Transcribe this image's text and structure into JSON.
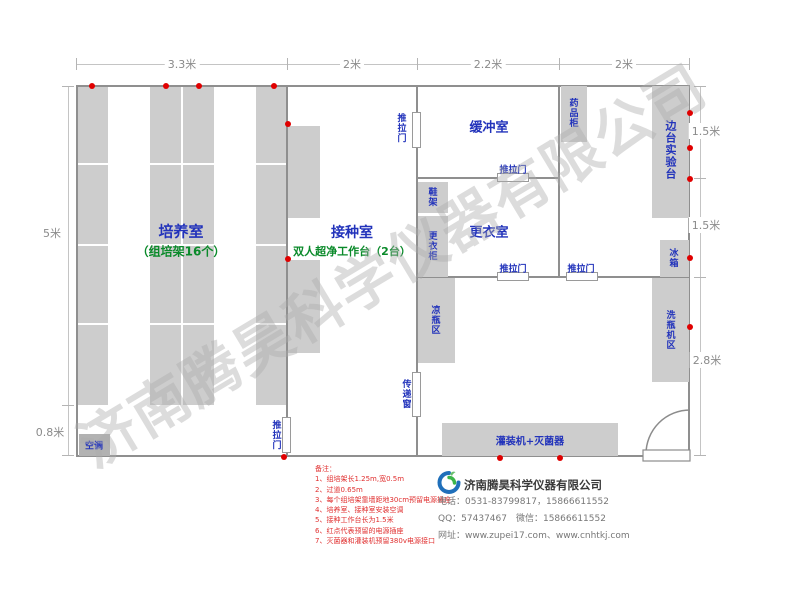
{
  "watermark": "济南腾昊科学仪器有限公司",
  "dimensions": {
    "top": [
      "3.3米",
      "2米",
      "2.2米",
      "2米"
    ],
    "left_height": "5米",
    "left_aisle": "0.8米",
    "right": [
      "1.5米",
      "1.5米",
      "2.8米"
    ]
  },
  "rooms": {
    "cultivation": "培养室",
    "cultivation_sub": "（组培架16个）",
    "inoculation": "接种室",
    "inoculation_sub": "双人超净工作台（2台）",
    "buffer": "缓冲室",
    "changing": "更衣室",
    "side_bench": "边台实验台"
  },
  "fixtures": {
    "sliding_door": "推拉门",
    "transfer_window": "传递窗",
    "medicine_cabinet": "药品柜",
    "shoe_rack": "鞋架",
    "wardrobe": "更衣柜",
    "cool_bottle_area": "凉瓶区",
    "fridge": "冰箱",
    "bottle_washer_area": "洗瓶机区",
    "filling_machine": "灌装机+灭菌器",
    "air_conditioner": "空调"
  },
  "notes": {
    "title": "备注：",
    "items": [
      "1、组培架长1.25m,宽0.5m",
      "2、过道0.65m",
      "3、每个组培架靠墙距地30cm预留电源插座",
      "4、培养室、接种室安装空调",
      "5、接种工作台长为1.5米",
      "6、红点代表预留的电源插座",
      "7、灭菌器和灌装机预留380v电源接口"
    ]
  },
  "company": {
    "name": "济南腾昊科学仪器有限公司",
    "phone": "电话：0531-83799817，15866611552",
    "qq_wechat": "QQ：57437467　微信：15866611552",
    "website": "网址：www.zupei17.com、www.cnhtkj.com"
  },
  "colors": {
    "room_label": "#2233bb",
    "sub_label": "#0a8a2a",
    "note_red": "#e03030",
    "dot_red": "#e00000",
    "wall": "#8f8f8f",
    "furniture": "#cdcdcd"
  }
}
